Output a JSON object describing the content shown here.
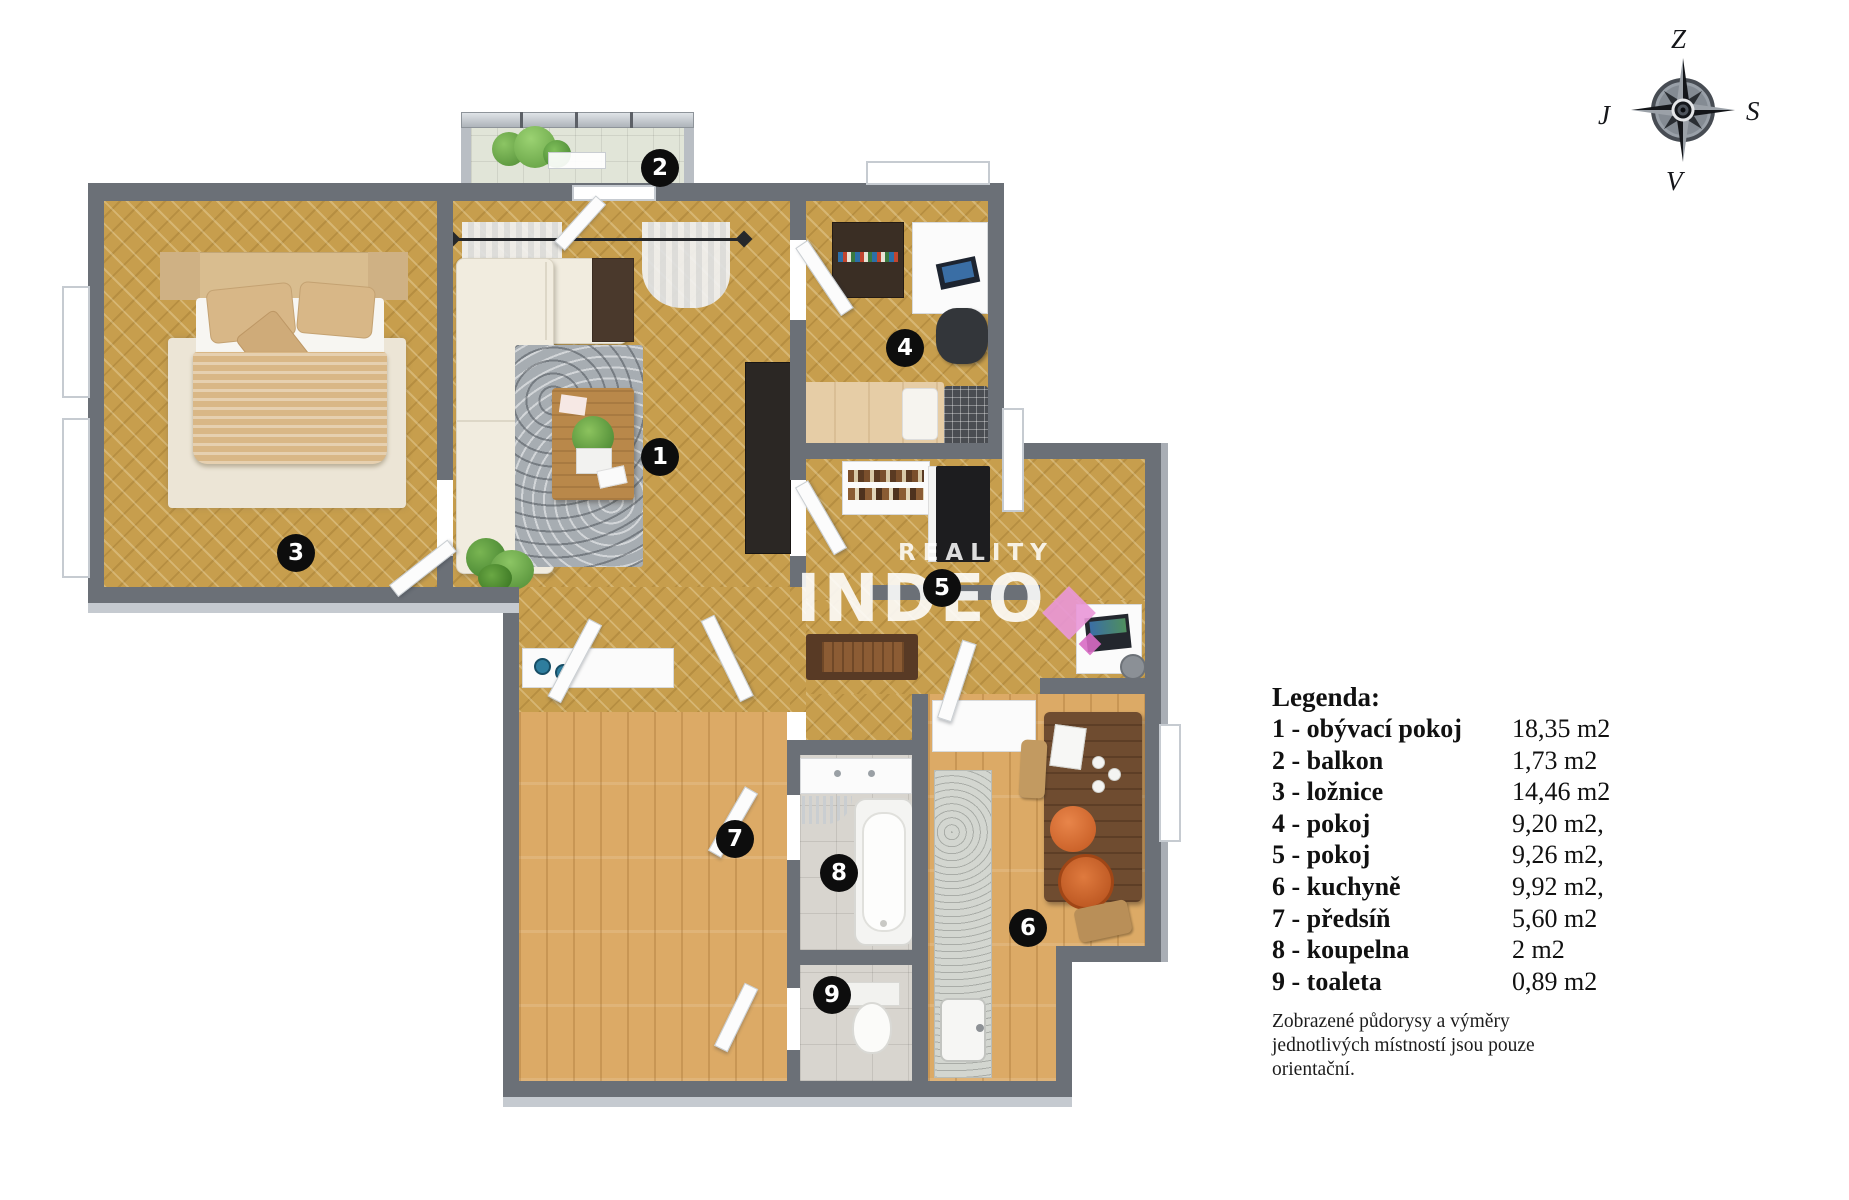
{
  "legend": {
    "title": "Legenda:",
    "rows": [
      {
        "label": "1 - obývací pokoj",
        "value": "18,35 m2"
      },
      {
        "label": "2 - balkon",
        "value": "1,73 m2"
      },
      {
        "label": "3 - ložnice",
        "value": "14,46 m2"
      },
      {
        "label": "4 - pokoj",
        "value": "9,20 m2,"
      },
      {
        "label": "5 - pokoj",
        "value": "9,26 m2,"
      },
      {
        "label": "6 - kuchyně",
        "value": "9,92 m2,"
      },
      {
        "label": "7 - předsíň",
        "value": "5,60 m2"
      },
      {
        "label": "8 - koupelna",
        "value": "2 m2"
      },
      {
        "label": "9 - toaleta",
        "value": "0,89 m2"
      }
    ],
    "disclaimer": "Zobrazené půdorysy a výměry jednotlivých místností jsou pouze orientační."
  },
  "compass": {
    "top": "Z",
    "right": "S",
    "bottom": "V",
    "left": "J"
  },
  "watermark": {
    "brand_top": "REALITY",
    "brand_main": "INDEO"
  },
  "plan": {
    "badges": [
      {
        "num": "1",
        "room": "obývací pokoj",
        "x": 660,
        "y": 457
      },
      {
        "num": "2",
        "room": "balkon",
        "x": 660,
        "y": 168
      },
      {
        "num": "3",
        "room": "ložnice",
        "x": 296,
        "y": 553
      },
      {
        "num": "4",
        "room": "pokoj",
        "x": 905,
        "y": 348
      },
      {
        "num": "5",
        "room": "pokoj",
        "x": 942,
        "y": 588
      },
      {
        "num": "6",
        "room": "kuchyně",
        "x": 1028,
        "y": 928
      },
      {
        "num": "7",
        "room": "předsíň",
        "x": 735,
        "y": 839
      },
      {
        "num": "8",
        "room": "koupelna",
        "x": 839,
        "y": 873
      },
      {
        "num": "9",
        "room": "toaleta",
        "x": 832,
        "y": 995
      }
    ],
    "colors": {
      "wall": "#6b7077",
      "parquet": "#c79e4d",
      "plank": "#dcaa66",
      "tile": "#d6d3cd",
      "balcony_tile": "#e0e4d6",
      "badge": "#0d0d0d",
      "watermark_pink": "#e39bd5"
    }
  }
}
